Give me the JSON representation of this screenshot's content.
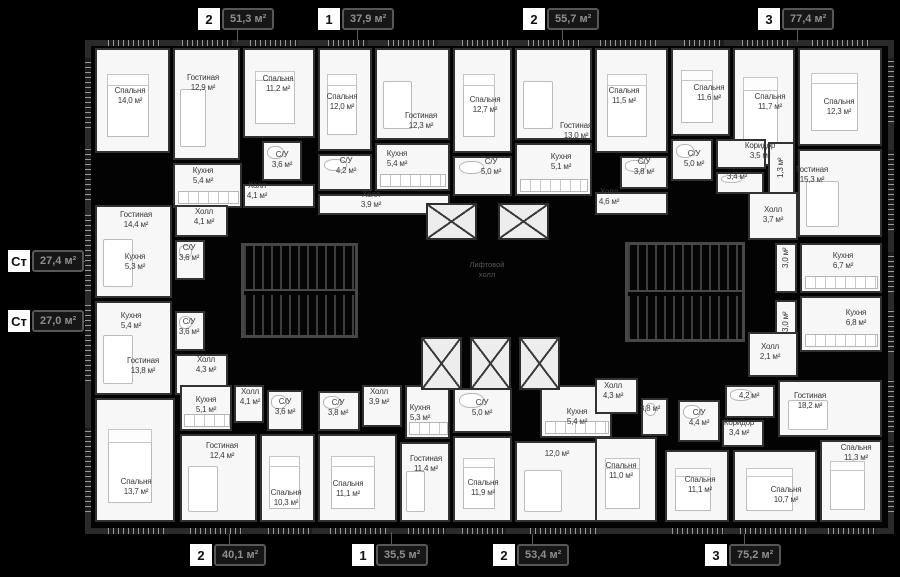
{
  "title": "Поэтажный план — план этажа жилого дома",
  "colors": {
    "background": "#000000",
    "wall": "#2a2a2a",
    "room_fill": "#f7f7f7",
    "room_label": "#383838",
    "badge_number_bg": "#ffffff",
    "badge_number_text": "#111111",
    "badge_area_bg": "#161616",
    "badge_area_border": "#575757",
    "badge_area_text": "#8f8f8f"
  },
  "core_label": {
    "line1": "Лифтовой",
    "line2": "холл"
  },
  "badges": {
    "top": [
      {
        "type": "2",
        "area": "51,3 м²",
        "x": 198,
        "cx": 237
      },
      {
        "type": "1",
        "area": "37,9 м²",
        "x": 318,
        "cx": 357
      },
      {
        "type": "2",
        "area": "55,7 м²",
        "x": 523,
        "cx": 562
      },
      {
        "type": "3",
        "area": "77,4 м²",
        "x": 758,
        "cx": 797
      }
    ],
    "bottom": [
      {
        "type": "2",
        "area": "40,1 м²",
        "x": 190,
        "cx": 229
      },
      {
        "type": "1",
        "area": "35,5 м²",
        "x": 352,
        "cx": 391
      },
      {
        "type": "2",
        "area": "53,4 м²",
        "x": 493,
        "cx": 532
      },
      {
        "type": "3",
        "area": "75,2 м²",
        "x": 705,
        "cx": 744
      }
    ],
    "left": [
      {
        "type": "Ст",
        "area": "27,4 м²",
        "y": 250,
        "cy": 261
      },
      {
        "type": "Ст",
        "area": "27,0 м²",
        "y": 310,
        "cy": 321
      }
    ]
  },
  "rooms": [
    {
      "name": "Спальня",
      "area": "14,0 м²",
      "x": 130,
      "y": 95
    },
    {
      "name": "Гостиная",
      "area": "12,9 м²",
      "x": 203,
      "y": 82
    },
    {
      "name": "Спальня",
      "area": "11,2 м²",
      "x": 278,
      "y": 83
    },
    {
      "name": "Кухня",
      "area": "5,4 м²",
      "x": 203,
      "y": 175
    },
    {
      "name": "С/У",
      "area": "3,6 м²",
      "x": 282,
      "y": 159
    },
    {
      "name": "Холл",
      "area": "4,1 м²",
      "x": 257,
      "y": 190
    },
    {
      "name": "Спальня",
      "area": "12,0 м²",
      "x": 342,
      "y": 101
    },
    {
      "name": "Гостиная",
      "area": "12,3 м²",
      "x": 421,
      "y": 120
    },
    {
      "name": "Кухня",
      "area": "5,4 м²",
      "x": 397,
      "y": 158
    },
    {
      "name": "С/У",
      "area": "4,2 м²",
      "x": 346,
      "y": 165
    },
    {
      "name": "Холл",
      "area": "3,9 м²",
      "x": 371,
      "y": 199
    },
    {
      "name": "Спальня",
      "area": "12,7 м²",
      "x": 485,
      "y": 104
    },
    {
      "name": "Гостиная",
      "area": "13,0 м²",
      "x": 576,
      "y": 130
    },
    {
      "name": "Кухня",
      "area": "5,1 м²",
      "x": 561,
      "y": 161
    },
    {
      "name": "С/У",
      "area": "5,0 м²",
      "x": 491,
      "y": 166
    },
    {
      "name": "Спальня",
      "area": "11,5 м²",
      "x": 624,
      "y": 95
    },
    {
      "name": "С/У",
      "area": "3,8 м²",
      "x": 644,
      "y": 166
    },
    {
      "name": "Холл",
      "area": "4,6 м²",
      "x": 609,
      "y": 196
    },
    {
      "name": "Спальня",
      "area": "11,6 м²",
      "x": 709,
      "y": 92
    },
    {
      "name": "Спальня",
      "area": "11,7 м²",
      "x": 770,
      "y": 101
    },
    {
      "name": "Спальня",
      "area": "12,3 м²",
      "x": 839,
      "y": 106
    },
    {
      "name": "С/У",
      "area": "5,0 м²",
      "x": 694,
      "y": 158
    },
    {
      "name": "Коридор",
      "area": "3,5 м²",
      "x": 760,
      "y": 150
    },
    {
      "name": "",
      "area": "3,4 м²",
      "x": 737,
      "y": 181
    },
    {
      "name": "",
      "area": "1,3 м²",
      "x": 781,
      "y": 172,
      "v": true
    },
    {
      "name": "Гостиная",
      "area": "15,3 м²",
      "x": 812,
      "y": 174
    },
    {
      "name": "Холл",
      "area": "3,7 м²",
      "x": 773,
      "y": 214
    },
    {
      "name": "",
      "area": "3,0 м²",
      "x": 786,
      "y": 262,
      "v": true
    },
    {
      "name": "Кухня",
      "area": "6,7 м²",
      "x": 843,
      "y": 260
    },
    {
      "name": "Гостиная",
      "area": "14,4 м²",
      "x": 136,
      "y": 219
    },
    {
      "name": "Кухня",
      "area": "5,3 м²",
      "x": 135,
      "y": 261
    },
    {
      "name": "С/У",
      "area": "3,6 м²",
      "x": 189,
      "y": 252
    },
    {
      "name": "Холл",
      "area": "4,1 м²",
      "x": 204,
      "y": 216
    },
    {
      "name": "Кухня",
      "area": "5,4 м²",
      "x": 131,
      "y": 320
    },
    {
      "name": "С/У",
      "area": "3,6 м²",
      "x": 189,
      "y": 326
    },
    {
      "name": "Гостиная",
      "area": "13,8 м²",
      "x": 143,
      "y": 365
    },
    {
      "name": "Холл",
      "area": "4,3 м²",
      "x": 206,
      "y": 364
    },
    {
      "name": "Кухня",
      "area": "5,1 м²",
      "x": 206,
      "y": 404
    },
    {
      "name": "Холл",
      "area": "4,1 м²",
      "x": 250,
      "y": 396
    },
    {
      "name": "С/У",
      "area": "3,6 м²",
      "x": 285,
      "y": 406
    },
    {
      "name": "Гостиная",
      "area": "12,4 м²",
      "x": 222,
      "y": 450
    },
    {
      "name": "Спальня",
      "area": "13,7 м²",
      "x": 136,
      "y": 486
    },
    {
      "name": "Спальня",
      "area": "10,3 м²",
      "x": 286,
      "y": 497
    },
    {
      "name": "С/У",
      "area": "3,8 м²",
      "x": 338,
      "y": 407
    },
    {
      "name": "Холл",
      "area": "3,9 м²",
      "x": 379,
      "y": 396
    },
    {
      "name": "Кухня",
      "area": "5,3 м²",
      "x": 420,
      "y": 412
    },
    {
      "name": "Спальня",
      "area": "11,1 м²",
      "x": 348,
      "y": 488
    },
    {
      "name": "Гостиная",
      "area": "11,4 м²",
      "x": 426,
      "y": 463
    },
    {
      "name": "С/У",
      "area": "5,0 м²",
      "x": 482,
      "y": 407
    },
    {
      "name": "Кухня",
      "area": "5,4 м²",
      "x": 577,
      "y": 416
    },
    {
      "name": "",
      "area": "12,0 м²",
      "x": 557,
      "y": 458
    },
    {
      "name": "Спальня",
      "area": "11,9 м²",
      "x": 483,
      "y": 487
    },
    {
      "name": "Холл",
      "area": "4,3 м²",
      "x": 613,
      "y": 390
    },
    {
      "name": "",
      "area": "3,8 м²",
      "x": 650,
      "y": 413
    },
    {
      "name": "Спальня",
      "area": "11,0 м²",
      "x": 621,
      "y": 470
    },
    {
      "name": "",
      "area": "3,0 м²",
      "x": 786,
      "y": 326,
      "v": true
    },
    {
      "name": "Кухня",
      "area": "6,8 м²",
      "x": 856,
      "y": 317
    },
    {
      "name": "Холл",
      "area": "2,1 м²",
      "x": 770,
      "y": 351
    },
    {
      "name": "",
      "area": "4,2 м²",
      "x": 749,
      "y": 400
    },
    {
      "name": "С/У",
      "area": "4,4 м²",
      "x": 699,
      "y": 417
    },
    {
      "name": "Коридор",
      "area": "3,4 м²",
      "x": 739,
      "y": 427
    },
    {
      "name": "Гостиная",
      "area": "18,2 м²",
      "x": 810,
      "y": 400
    },
    {
      "name": "Спальня",
      "area": "11,3 м²",
      "x": 856,
      "y": 452
    },
    {
      "name": "Спальня",
      "area": "11,1 м²",
      "x": 700,
      "y": 484
    },
    {
      "name": "Спальня",
      "area": "10,7 м²",
      "x": 786,
      "y": 494
    }
  ]
}
